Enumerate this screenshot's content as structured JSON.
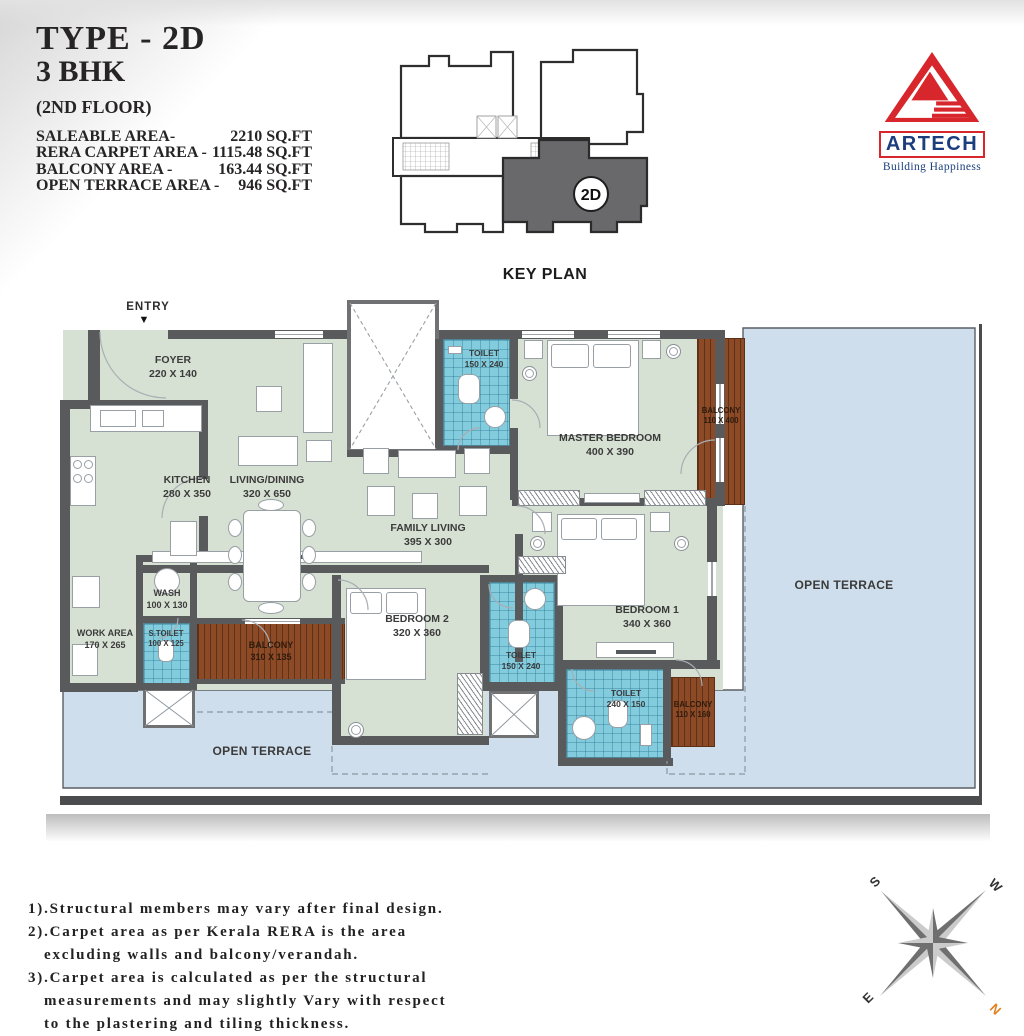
{
  "title_block": {
    "type": "TYPE - 2D",
    "bhk": "3 BHK",
    "floor": "(2ND FLOOR)",
    "areas": [
      {
        "label": "SALEABLE AREA-",
        "value": "2210 SQ.FT"
      },
      {
        "label": "RERA CARPET AREA -",
        "value": "1115.48 SQ.FT"
      },
      {
        "label": "BALCONY AREA -",
        "value": "163.44 SQ.FT"
      },
      {
        "label": "OPEN TERRACE AREA -",
        "value": "946 SQ.FT"
      }
    ]
  },
  "key_plan": {
    "caption": "KEY PLAN",
    "unit_badge": "2D"
  },
  "logo": {
    "brand": "ARTECH",
    "tagline": "Building Happiness"
  },
  "plan": {
    "entry_label": "ENTRY",
    "entry_arrow": "▼",
    "open_terrace_right": "OPEN TERRACE",
    "open_terrace_bottom": "OPEN TERRACE",
    "rooms": {
      "foyer": {
        "name": "FOYER",
        "dims": "220 X 140"
      },
      "kitchen": {
        "name": "KITCHEN",
        "dims": "280 X 350"
      },
      "living": {
        "name": "LIVING/DINING",
        "dims": "320 X 650"
      },
      "family": {
        "name": "FAMILY LIVING",
        "dims": "395 X 300"
      },
      "master": {
        "name": "MASTER BEDROOM",
        "dims": "400 X 390"
      },
      "bedroom1": {
        "name": "BEDROOM 1",
        "dims": "340 X 360"
      },
      "bedroom2": {
        "name": "BEDROOM 2",
        "dims": "320 X 360"
      },
      "toilet_top": {
        "name": "TOILET",
        "dims": "150 X 240"
      },
      "toilet_mid": {
        "name": "TOILET",
        "dims": "150 X 240"
      },
      "toilet_bottom": {
        "name": "TOILET",
        "dims": "240 X 150"
      },
      "s_toilet": {
        "name": "S.TOILET",
        "dims": "100 X 125"
      },
      "wash": {
        "name": "WASH",
        "dims": "100 X 130"
      },
      "work_area": {
        "name": "WORK AREA",
        "dims": "170 X 265"
      },
      "balcony_master": {
        "name": "BALCONY",
        "dims": "110 X 400"
      },
      "balcony_left": {
        "name": "BALCONY",
        "dims": "310 X 135"
      },
      "balcony_bed1": {
        "name": "BALCONY",
        "dims": "110 X 160"
      }
    }
  },
  "notes": {
    "lines": [
      "1).Structural members may vary after final design.",
      "2).Carpet area as per Kerala RERA is the area",
      "excluding walls and balcony/verandah.",
      "3).Carpet area is calculated as per the structural",
      "measurements and may slightly Vary with respect",
      "to the plastering and tiling thickness."
    ]
  },
  "compass": {
    "n": "N",
    "s": "S",
    "e": "E",
    "w": "W"
  },
  "colors": {
    "wall": "#595a5c",
    "room_fill": "#d7e1d3",
    "toilet_fill": "#83ccde",
    "balcony_fill": "#8c4a27",
    "terrace_fill": "#cfdeec",
    "logo_red": "#d7262c",
    "logo_navy": "#1c3e7e",
    "north_orange": "#e0801f",
    "keyplan_unit": "#69696b"
  }
}
